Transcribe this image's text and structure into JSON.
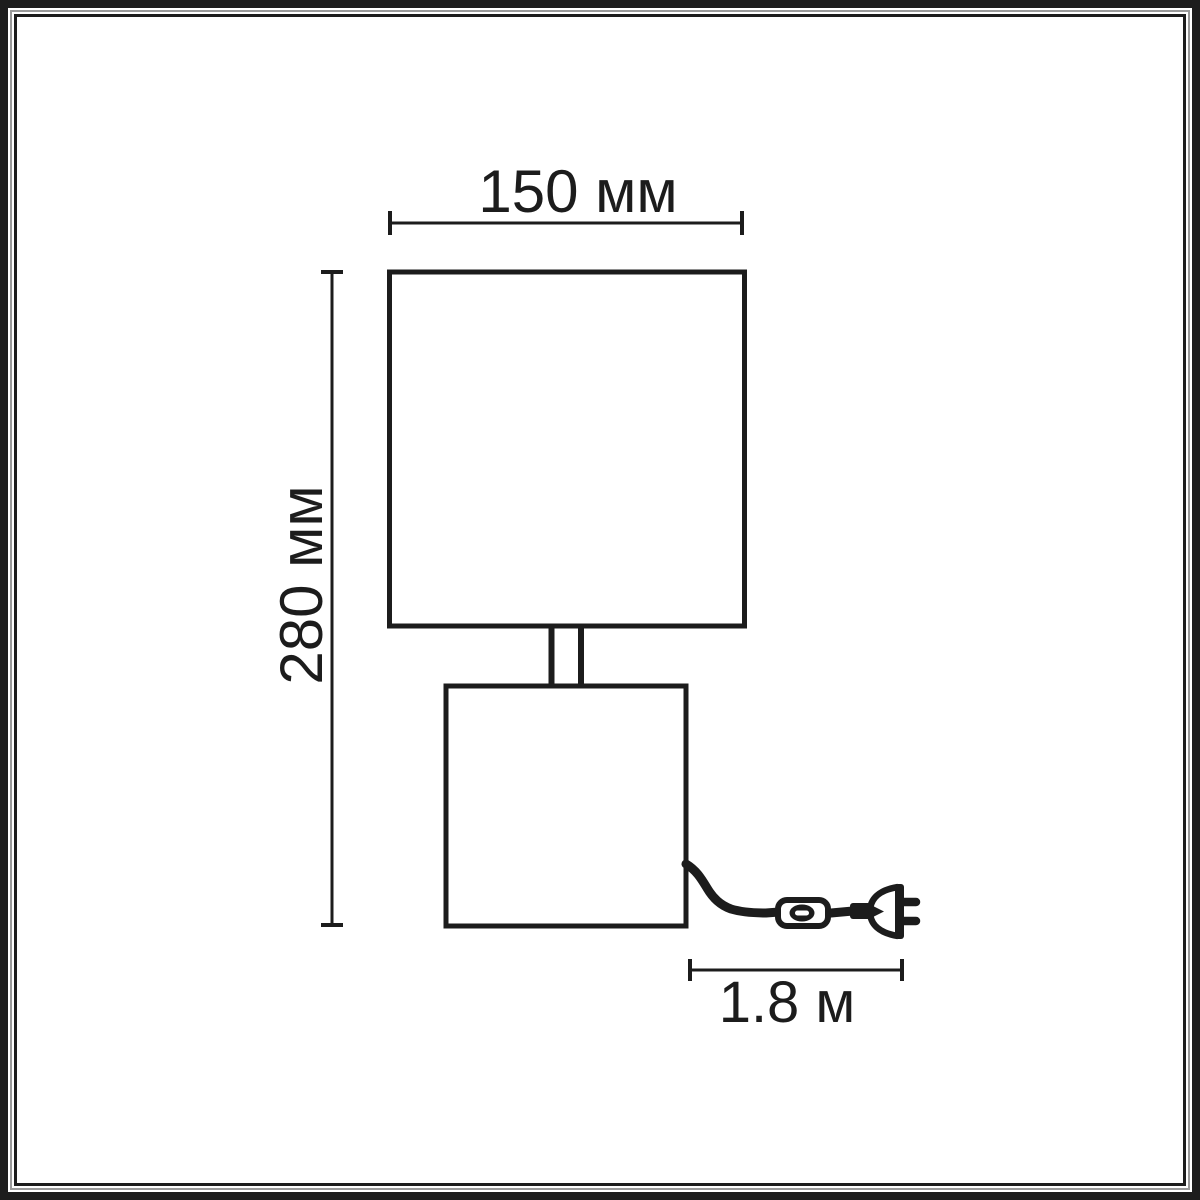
{
  "diagram": {
    "kind": "table-lamp-dimension-drawing",
    "width_label": "150 мм",
    "height_label": "280 мм",
    "cord_length_label": "1.8 м"
  },
  "colors": {
    "line": "#1c1c1c",
    "background": "#ffffff",
    "frame_primary": "#1d1d1d",
    "frame_secondary": "#9a9a9a"
  }
}
